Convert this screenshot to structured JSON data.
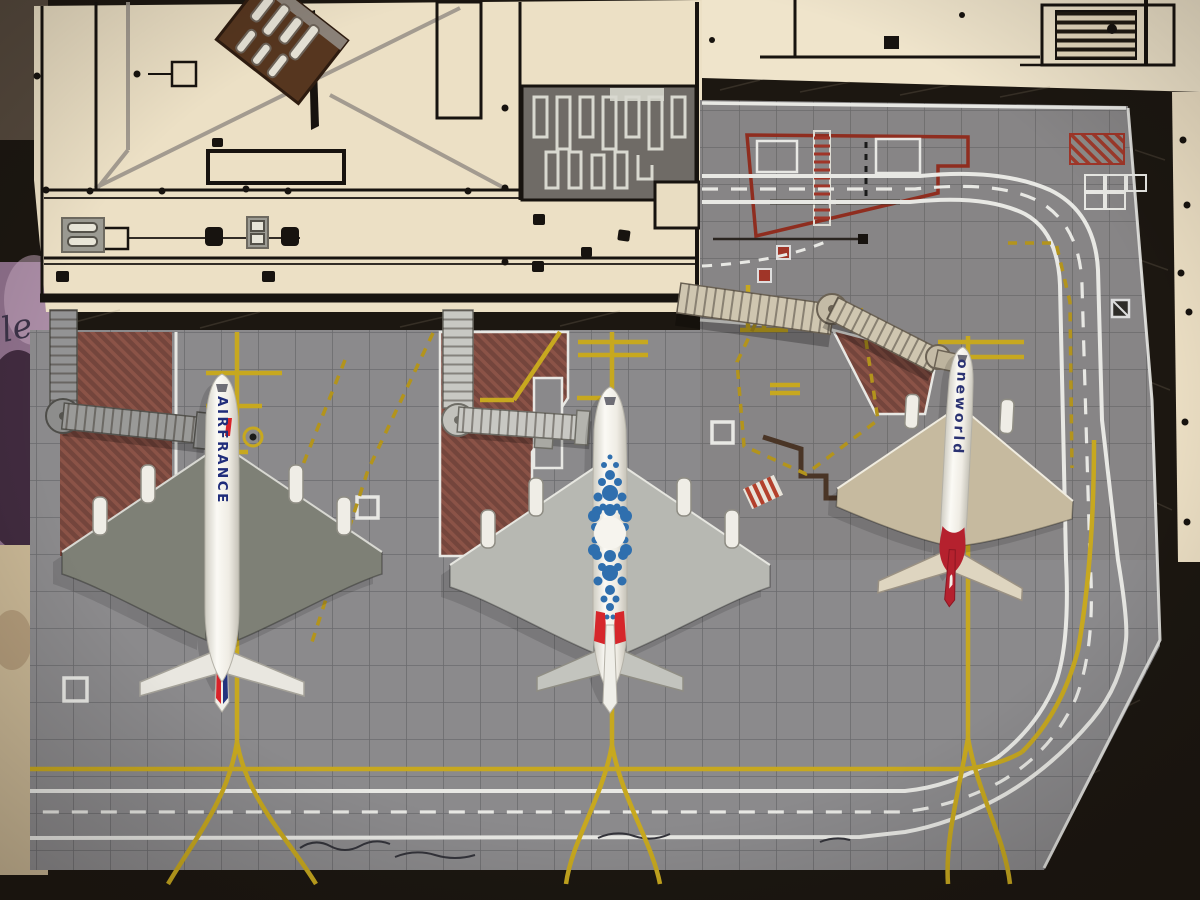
{
  "scene": {
    "type": "photograph of a hand-built model airport diorama, top view",
    "surface_script_text": "le"
  },
  "aircraft": {
    "left": {
      "airline": "Air France",
      "model": "A380",
      "fuselage_text": "AIRFRANCE",
      "text_color": "#1f2c7a",
      "accent_color": "#d8232a",
      "wing_color": "#7e8076"
    },
    "middle": {
      "airline": "blue-dot mosaic special livery",
      "model": "A380",
      "fuselage_text": "",
      "dot_color": "#2f6fae",
      "tail_accent": "#d6262b",
      "wing_color": "#b7b8b2"
    },
    "right": {
      "airline": "Qantas oneworld",
      "model": "twinjet",
      "fuselage_text": "oneworld",
      "text_color": "#2a3272",
      "tail_color": "#b5212e",
      "wing_color": "#c6ba9f"
    }
  },
  "colors": {
    "mat": "#8b8a8c",
    "terminal": "#ece0c5",
    "fabric": "#8d6f8a",
    "ink": "#17130f",
    "dark_gap": "#1c1711",
    "taxiline": "#c7a81f",
    "taxiline_dashed": "#b3941c",
    "road_white": "#e8e8e4",
    "red_marking": "#8f2d1f",
    "red_zone_hatch": "#74453c",
    "apron_red_stripe": "#9e3a2b",
    "bridge_gray": "#939394",
    "bridge_light": "#c8c8c3",
    "bridge_tan": "#cfc6b0",
    "fuselage_white": "#f4f2ec",
    "skylight_gray": "#6f6b66"
  }
}
